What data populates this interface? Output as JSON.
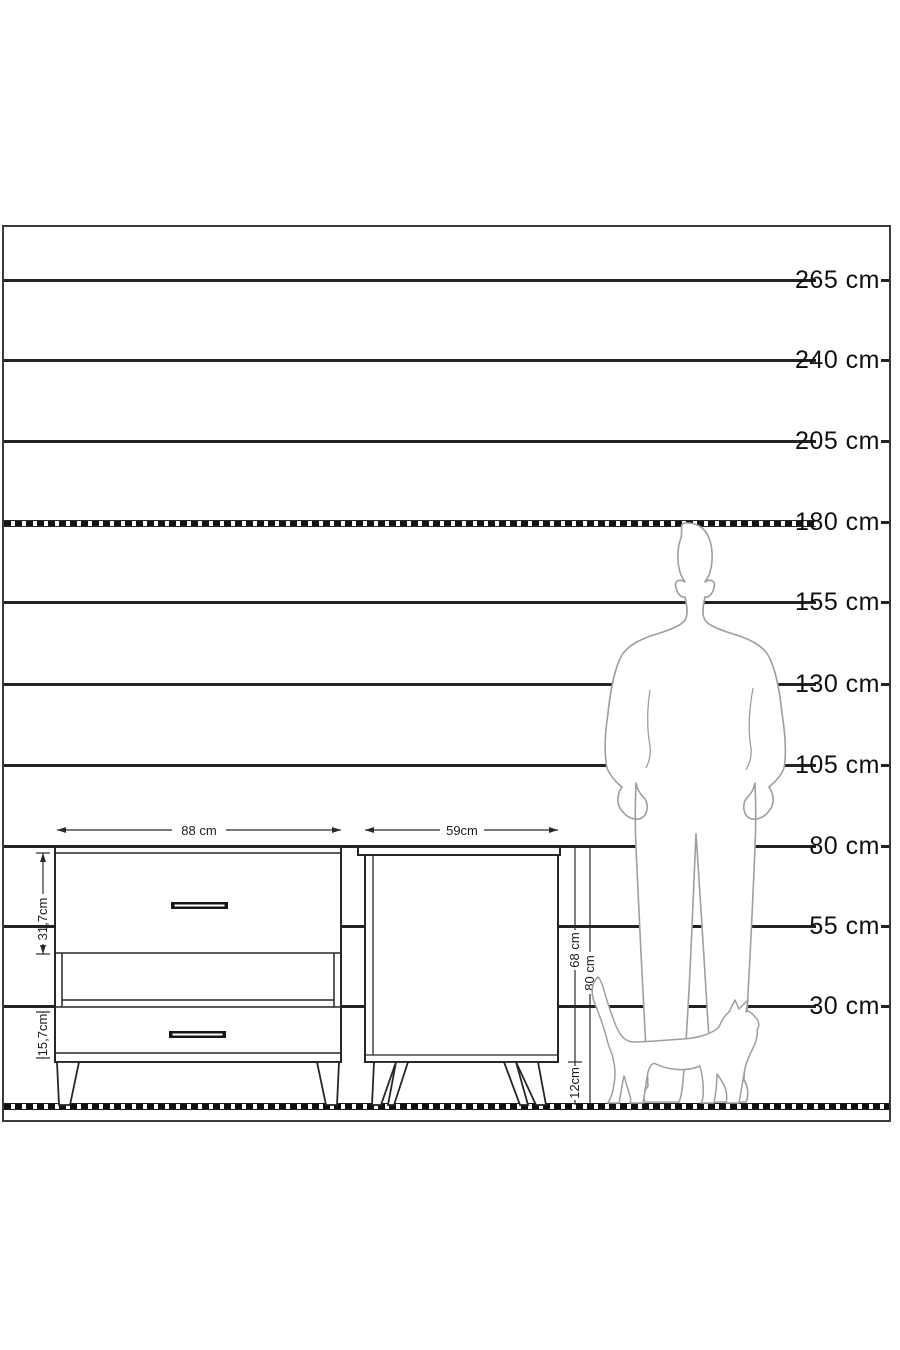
{
  "scale": {
    "lines": [
      {
        "label": "265 cm",
        "style": "solid"
      },
      {
        "label": "240 cm",
        "style": "solid"
      },
      {
        "label": "205 cm",
        "style": "solid"
      },
      {
        "label": "180 cm",
        "style": "dashed"
      },
      {
        "label": "155 cm",
        "style": "solid"
      },
      {
        "label": "130 cm",
        "style": "solid"
      },
      {
        "label": "105 cm",
        "style": "solid"
      },
      {
        "label": "80 cm",
        "style": "solid"
      },
      {
        "label": "55 cm",
        "style": "solid"
      },
      {
        "label": "30 cm",
        "style": "solid"
      }
    ],
    "unit": "cm"
  },
  "dresser": {
    "width": "88 cm",
    "top_drawer_height": "31,7cm",
    "bottom_drawer_height": "15,7cm"
  },
  "nightstand": {
    "width": "59cm",
    "body_height": "68 cm",
    "leg_height": "12cm",
    "total_height": "80 cm"
  },
  "colors": {
    "line": "#232323",
    "silhouette_outline": "#9e9e9e",
    "background": "#ffffff"
  }
}
